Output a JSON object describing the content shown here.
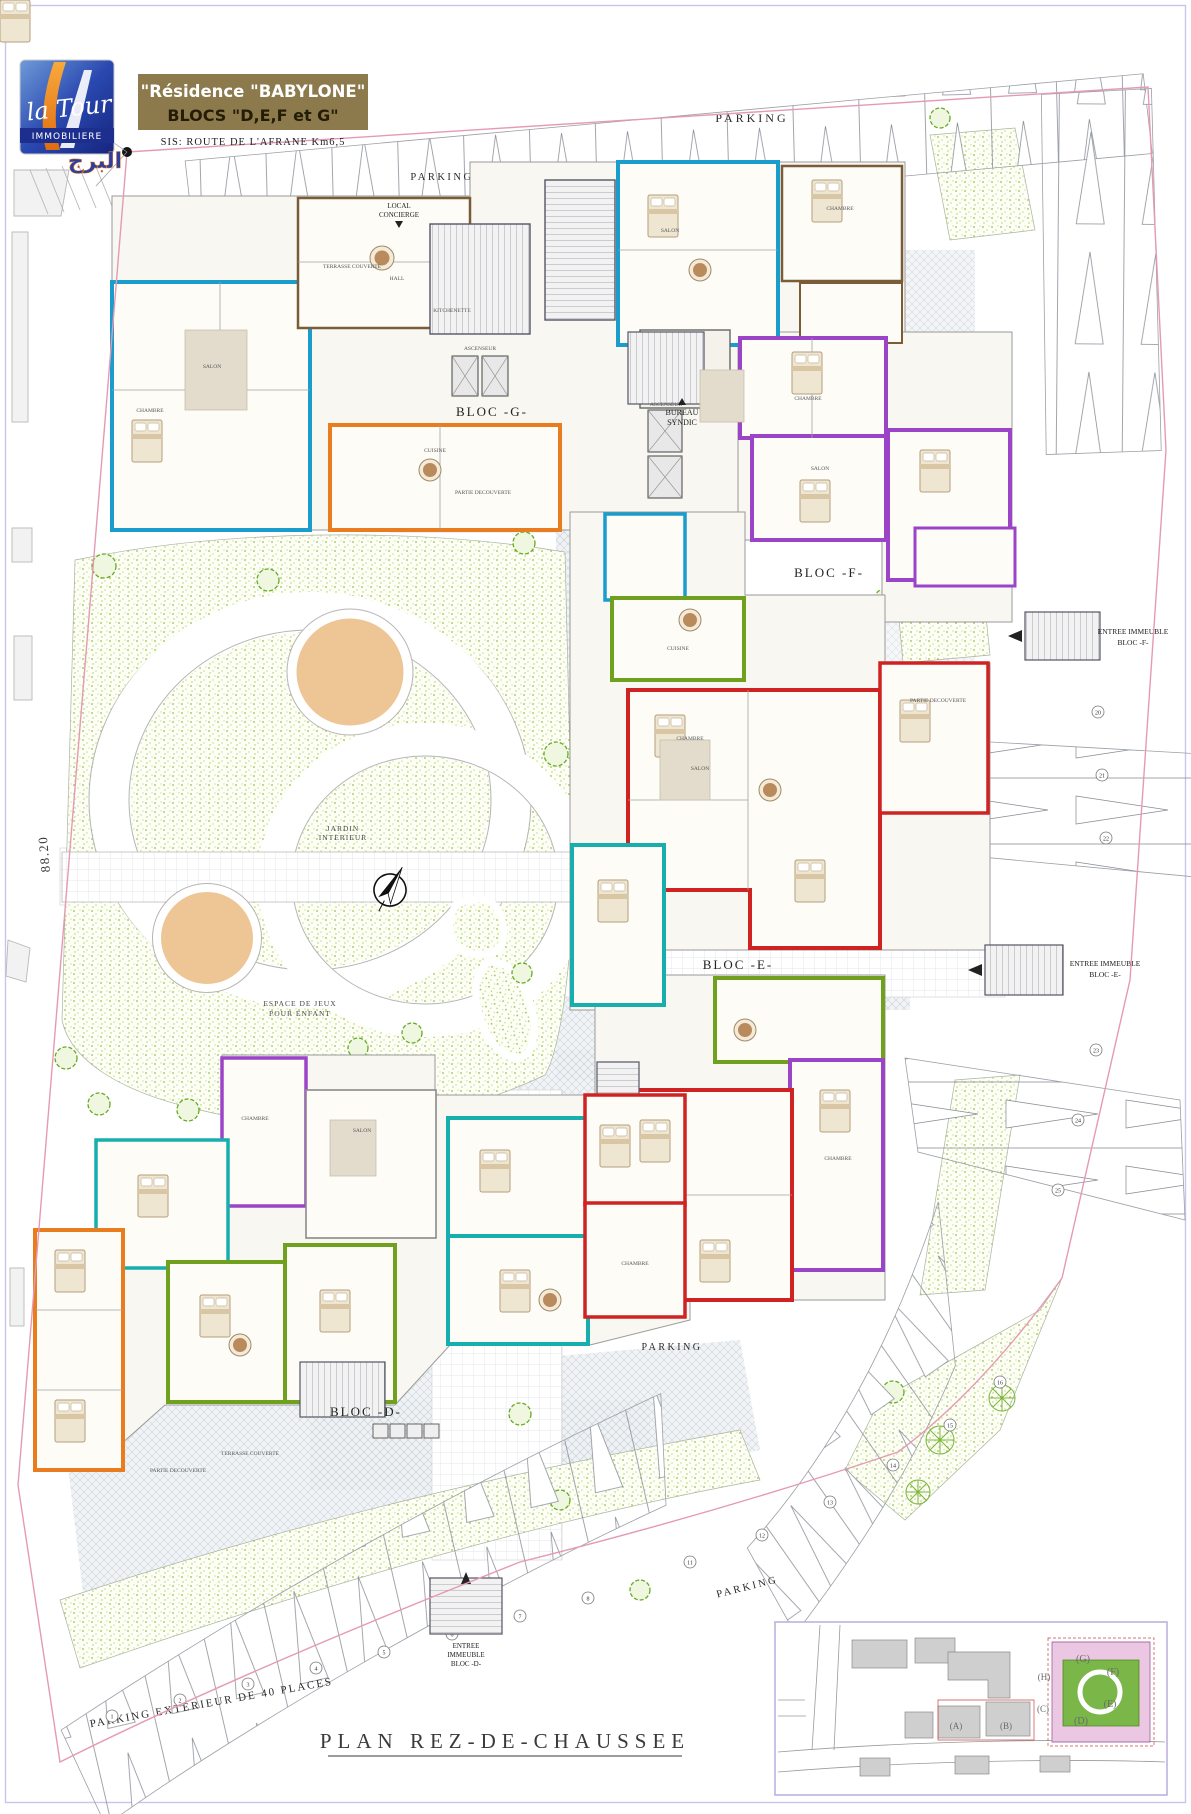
{
  "logo": {
    "script": "la Tour",
    "caption": "IMMOBILIERE",
    "arabic": "البرج"
  },
  "title_block": {
    "line1": "\"Résidence  \"BABYLONE\"",
    "line2": "BLOCS \"D,E,F et G\"",
    "address": "SIS:   ROUTE  DE  L'AFRANE  Km6,5"
  },
  "plan": {
    "labels": {
      "parking": "PARKING",
      "parking_exterieur": "PARKING  EXTERIEUR  DE  40  PLACES",
      "entree_sortie_1": "ENTREE  ET  SORTIE",
      "entree_sortie_2": "PARKINGS",
      "local_concierge_1": "LOCAL",
      "local_concierge_2": "CONCIERGE",
      "bureau_syndic_1": "BUREAU",
      "bureau_syndic_2": "SYNDIC",
      "bloc_g": "BLOC  -G-",
      "bloc_f": "BLOC  -F-",
      "bloc_e": "BLOC  -E-",
      "bloc_d": "BLOC  -D-",
      "entree_immeuble": "ENTREE  IMMEUBLE",
      "entree_f": "BLOC  -F-",
      "entree_e": "BLOC  -E-",
      "entree_d_1": "ENTREE",
      "entree_d_2": "IMMEUBLE",
      "entree_d_3": "BLOC  -D-",
      "jardin_1": "JARDIN",
      "jardin_2": "INTERIEUR",
      "espace_1": "ESPACE  DE  JEUX",
      "espace_2": "POUR  ENFANT",
      "dim_88": "88.20",
      "plan_title": "PLAN  REZ-DE-CHAUSSEE"
    },
    "rooms": {
      "salon": "SALON",
      "chambre": "CHAMBRE",
      "cuisine": "CUISINE",
      "kitchenette": "KITCHENETTE",
      "hall": "HALL",
      "ascenseur": "ASCENSEUR",
      "terrasse_couverte": "TERRASSE COUVERTE",
      "partie_decouverte": "PARTIE DECOUVERTE"
    },
    "stalls": {
      "top": [
        "35",
        "36",
        "37",
        "38",
        "39",
        "40"
      ],
      "right": [
        "20",
        "21",
        "22",
        "23",
        "24",
        "25"
      ],
      "bottom": [
        "1",
        "2",
        "3",
        "4",
        "5",
        "6",
        "7",
        "8"
      ],
      "southeast": [
        "11",
        "12",
        "13",
        "14",
        "15",
        "16"
      ]
    }
  },
  "site_map": {
    "blocks": {
      "a": "(A)",
      "b": "(B)",
      "c": "(C)",
      "h": "(H)",
      "g": "(G)",
      "f": "(F)",
      "e": "(E)",
      "d": "(D)"
    }
  },
  "colors": {
    "bloc_cyan": "#1a9ccc",
    "bloc_teal": "#17aeae",
    "bloc_orange": "#e87c1e",
    "bloc_purple": "#9b44c8",
    "bloc_red": "#cf2222",
    "bloc_green": "#6fa01e",
    "boundary_pink": "#e59ab4",
    "banner_bg": "#8c7a4c",
    "logo_blue": "#2a3fa6",
    "logo_orange": "#f08018",
    "sand": "#eec696",
    "grass": "#a4c74e"
  }
}
